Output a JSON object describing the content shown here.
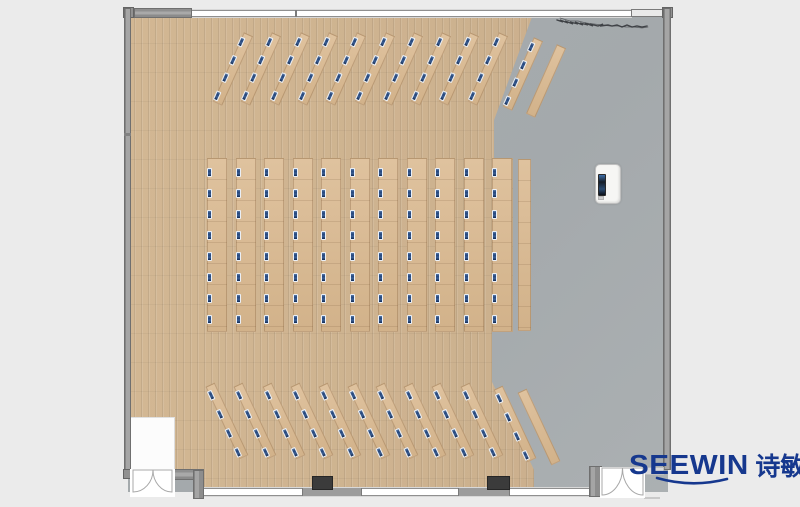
{
  "branding": {
    "wordmark": "SEEWIN",
    "cjk": "诗敏"
  },
  "colors": {
    "page_bg": "#ebebeb",
    "floor_gray": "#a8adb0",
    "wood_base": "#c9ae8c",
    "wood_light": "#d2b793",
    "desk_light": "#dfc29e",
    "desk_dark": "#d2b28a",
    "chair_blue": "#24467c",
    "wall_gray": "#9c9c9c",
    "wall_edge": "#6f6f6f",
    "window_white": "#ffffff",
    "column_dark": "#3b3b3b",
    "podium_body": "#f6f6f4",
    "screen_dark": "#161e29",
    "logo_blue": "#16388e"
  },
  "floorplan": {
    "features": [
      "lectern",
      "double-door-southwest",
      "double-door-southeast",
      "whiteboard",
      "wall-scribble"
    ],
    "bands": [
      {
        "id": "north-angled-rows",
        "type": "angled",
        "angle_deg": 24,
        "count": 10,
        "cx0": 233,
        "pitch": 28.3,
        "cy": 69,
        "strip_w": 10,
        "strip_h": 76,
        "chairs": 4,
        "extras": [
          {
            "cx": 523,
            "cy": 74,
            "chairs": 4
          },
          {
            "cx": 546,
            "cy": 81,
            "chairs": 0
          }
        ]
      },
      {
        "id": "center-straight-rows",
        "type": "vertical",
        "count": 11,
        "x0": 207,
        "pitch": 28.5,
        "y": 158,
        "strip_w": 20,
        "strip_h": 174,
        "chairs": 8,
        "extras": [
          {
            "x": 518,
            "y": 159,
            "w": 13,
            "h": 172,
            "chairs": 0
          }
        ]
      },
      {
        "id": "south-angled-rows",
        "type": "angled",
        "angle_deg": -25,
        "count": 10,
        "cx0": 227,
        "pitch": 28.3,
        "cy": 421,
        "strip_w": 10,
        "strip_h": 80,
        "chairs": 4,
        "extras": [
          {
            "cx": 515,
            "cy": 424,
            "chairs": 4
          },
          {
            "cx": 539,
            "cy": 427,
            "chairs": 0
          }
        ]
      }
    ]
  }
}
